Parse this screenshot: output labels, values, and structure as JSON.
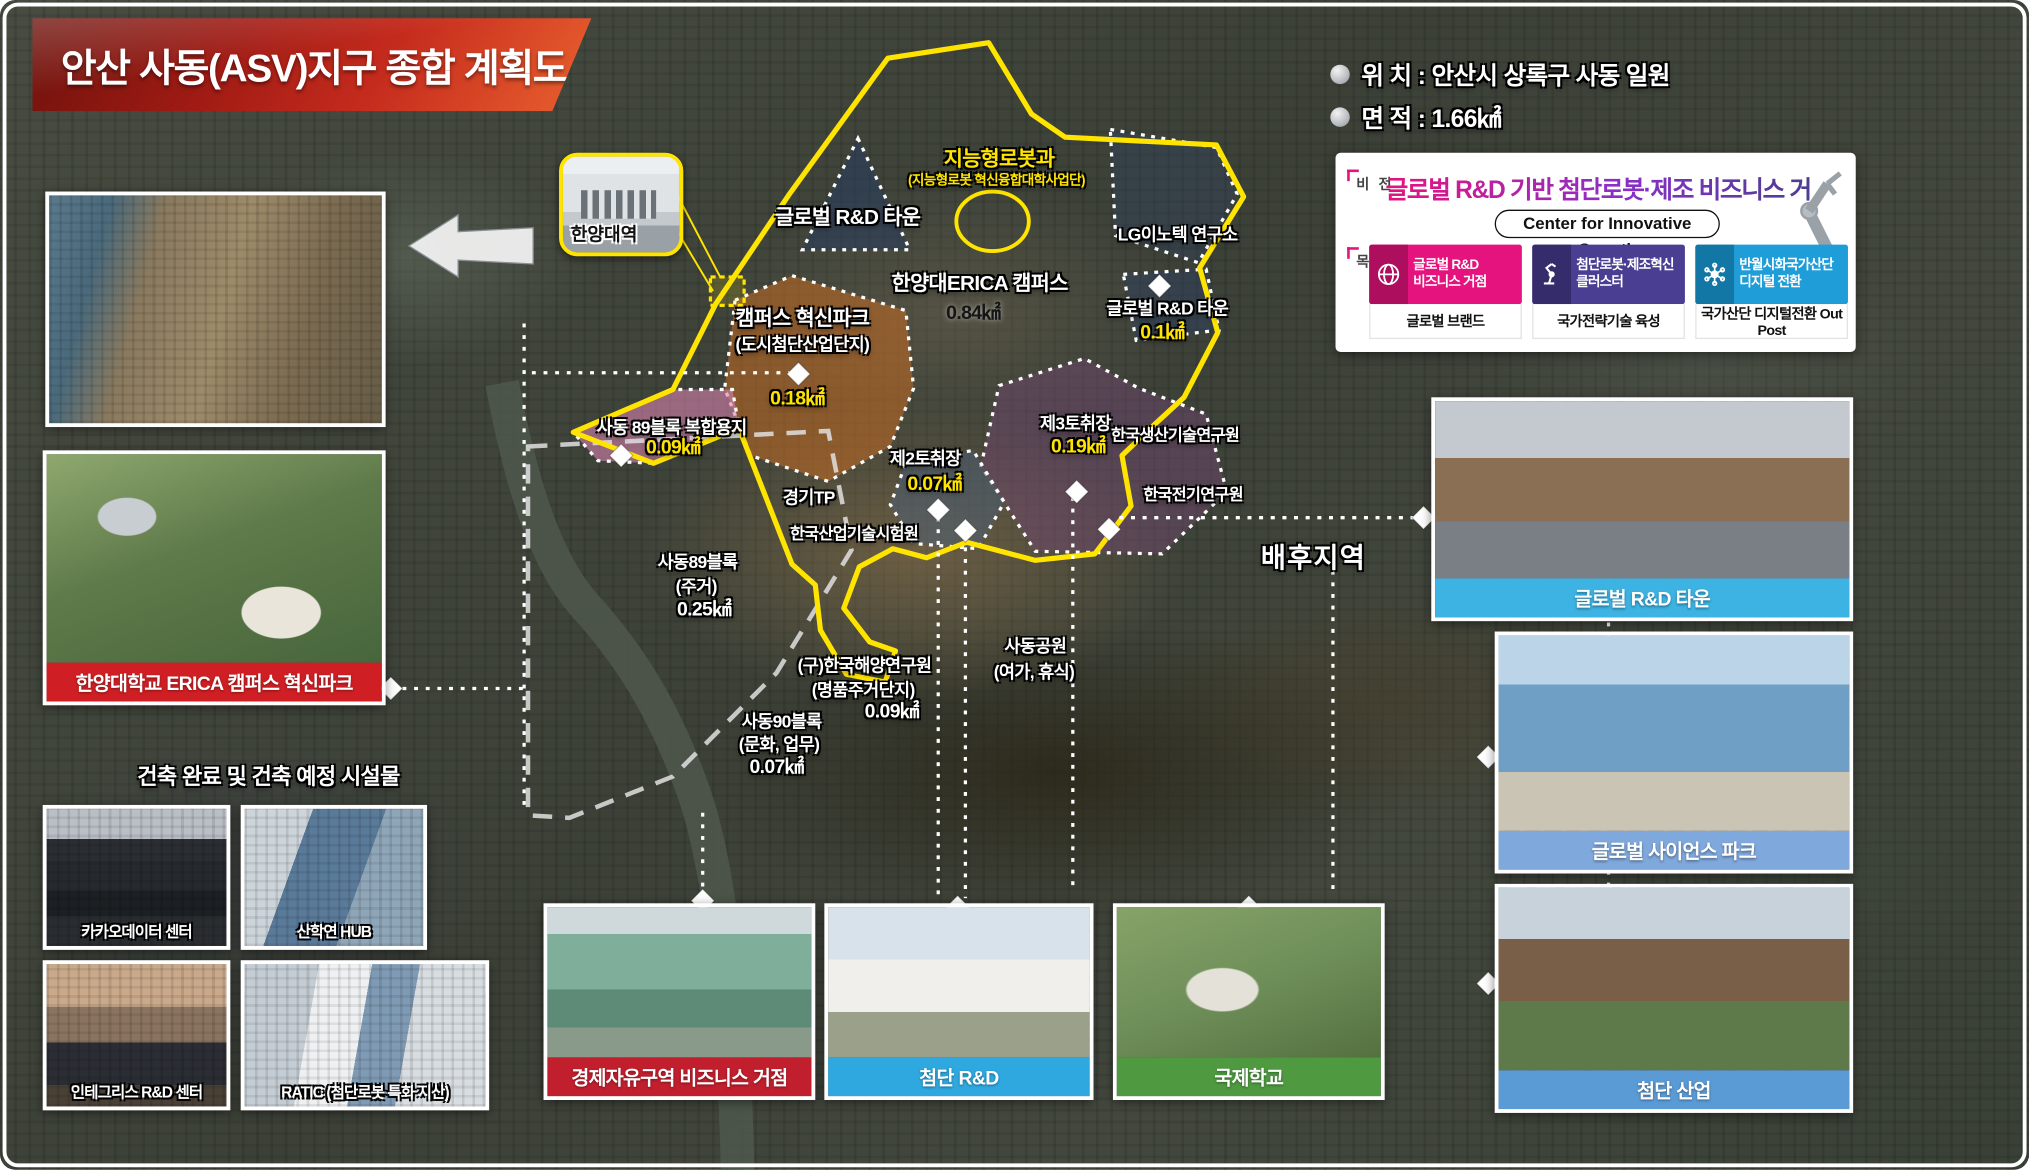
{
  "banner": {
    "title": "안산 사동(ASV)지구 종합 계획도"
  },
  "info": {
    "location_label": "위 치 :",
    "location_value": "안산시 상록구 사동 일원",
    "area_label": "면 적 :",
    "area_value": "1.66㎢"
  },
  "vision_box": {
    "vision_label": "비 전",
    "goal_label": "목 표",
    "title": "글로벌 R&D 기반 첨단로봇·제조 비즈니스 거점",
    "subtitle": "Center for Innovative Growth",
    "goals": [
      {
        "line1": "글로벌 R&D",
        "line2": "비즈니스 거점",
        "sub": "글로벌 브랜드",
        "color": "#e5137d",
        "dark": "#ad0e5e",
        "icon": "globe-icon"
      },
      {
        "line1": "첨단로봇·제조혁신",
        "line2": "클러스터",
        "sub": "국가전략기술 육성",
        "color": "#4a3e92",
        "dark": "#352c6b",
        "icon": "robot-arm-icon"
      },
      {
        "line1": "반월시화국가산단",
        "line2": "디지털 전환",
        "sub": "국가산단 디지털전환 Out Post",
        "color": "#1f9dd9",
        "dark": "#1377a6",
        "icon": "network-icon"
      }
    ]
  },
  "station": {
    "label": "한양대역"
  },
  "map_labels": [
    {
      "text": "지능형로봇과",
      "x": 772,
      "y": 121,
      "cls": "yellow lg"
    },
    {
      "text": "(지능형로봇 혁신융합대학사업단)",
      "x": 770,
      "y": 139,
      "cls": "yellow sm"
    },
    {
      "text": "글로벌 R&D 타운",
      "x": 655,
      "y": 166,
      "cls": "white lg"
    },
    {
      "text": "LG이노텍 연구소",
      "x": 910,
      "y": 180,
      "cls": "white md"
    },
    {
      "text": "한양대ERICA 캠퍼스",
      "x": 757,
      "y": 217,
      "cls": "white lg"
    },
    {
      "text": "0.84㎢",
      "x": 752,
      "y": 241,
      "cls": "black area"
    },
    {
      "text": "글로벌 R&D 타운",
      "x": 902,
      "y": 237,
      "cls": "white md"
    },
    {
      "text": "0.1㎢",
      "x": 898,
      "y": 256,
      "cls": "yellow area"
    },
    {
      "text": "캠퍼스 혁신파크",
      "x": 620,
      "y": 244,
      "cls": "white lg"
    },
    {
      "text": "(도시첨단산업단지)",
      "x": 620,
      "y": 265,
      "cls": "white md"
    },
    {
      "text": "0.18㎢",
      "x": 616,
      "y": 307,
      "cls": "yellow area"
    },
    {
      "text": "사동 89블록 복합용지",
      "x": 519,
      "y": 329,
      "cls": "white md"
    },
    {
      "text": "0.09㎢",
      "x": 520,
      "y": 345,
      "cls": "yellow area"
    },
    {
      "text": "제3토취장",
      "x": 831,
      "y": 326,
      "cls": "white md"
    },
    {
      "text": "0.19㎢",
      "x": 833,
      "y": 344,
      "cls": "yellow area"
    },
    {
      "text": "한국생산기술연구원",
      "x": 908,
      "y": 335,
      "cls": "white sm2"
    },
    {
      "text": "제2토취장",
      "x": 715,
      "y": 353,
      "cls": "white md"
    },
    {
      "text": "0.07㎢",
      "x": 722,
      "y": 373,
      "cls": "yellow area"
    },
    {
      "text": "경기TP",
      "x": 625,
      "y": 383,
      "cls": "white md"
    },
    {
      "text": "한국산업기술시험원",
      "x": 660,
      "y": 411,
      "cls": "white sm2"
    },
    {
      "text": "한국전기연구원",
      "x": 922,
      "y": 381,
      "cls": "white sm2"
    },
    {
      "text": "배후지역",
      "x": 1015,
      "y": 430,
      "cls": "white xl"
    },
    {
      "text": "사동89블록",
      "x": 539,
      "y": 433,
      "cls": "white md"
    },
    {
      "text": "(주거)",
      "x": 538,
      "y": 452,
      "cls": "white md"
    },
    {
      "text": "0.25㎢",
      "x": 544,
      "y": 470,
      "cls": "white area"
    },
    {
      "text": "(구)한국해양연구원",
      "x": 668,
      "y": 513,
      "cls": "white md"
    },
    {
      "text": "(명품주거단지)",
      "x": 667,
      "y": 532,
      "cls": "white md"
    },
    {
      "text": "0.09㎢",
      "x": 689,
      "y": 549,
      "cls": "white area"
    },
    {
      "text": "사동공원",
      "x": 800,
      "y": 498,
      "cls": "white md"
    },
    {
      "text": "(여가, 휴식)",
      "x": 799,
      "y": 518,
      "cls": "white md"
    },
    {
      "text": "사동90블록",
      "x": 604,
      "y": 556,
      "cls": "white md"
    },
    {
      "text": "(문화, 업무)",
      "x": 602,
      "y": 574,
      "cls": "white md"
    },
    {
      "text": "0.07㎢",
      "x": 600,
      "y": 592,
      "cls": "white area"
    }
  ],
  "left_panel": {
    "erica_caption": "한양대학교 ERICA 캠퍼스 혁신파크",
    "erica_caption_color": "#cf1f24",
    "facilities_title": "건축 완료 및 건축 예정 시설물",
    "facilities": [
      {
        "label": "카카오데이터 센터",
        "x": 33,
        "y": 622,
        "w": 145,
        "h": 112,
        "ph": "ph-kakao"
      },
      {
        "label": "산학연 HUB",
        "x": 186,
        "y": 622,
        "w": 144,
        "h": 112,
        "ph": "ph-hub"
      },
      {
        "label": "인테그리스 R&D 센터",
        "x": 33,
        "y": 742,
        "w": 145,
        "h": 116,
        "ph": "ph-integris"
      },
      {
        "label": "RATIC (첨단로봇 특화 지산)",
        "x": 186,
        "y": 742,
        "w": 192,
        "h": 116,
        "ph": "ph-ratic"
      }
    ]
  },
  "bottom_cards": [
    {
      "label": "경제자유구역 비즈니스 거점",
      "color": "#c21f2e",
      "x": 420,
      "y": 698,
      "w": 210,
      "h": 152,
      "ph": "ph-econ"
    },
    {
      "label": "첨단 R&D",
      "color": "#2fa8e0",
      "x": 637,
      "y": 698,
      "w": 208,
      "h": 152,
      "ph": "ph-rnd"
    },
    {
      "label": "국제학교",
      "color": "#4f9a41",
      "x": 860,
      "y": 698,
      "w": 210,
      "h": 152,
      "ph": "ph-school"
    }
  ],
  "right_cards": [
    {
      "label": "글로벌 R&D 타운",
      "color": "#3db3e3",
      "x": 1106,
      "y": 307,
      "w": 326,
      "h": 173,
      "ph": "ph-rndtown"
    },
    {
      "label": "글로벌 사이언스 파크",
      "color": "#7fa8dc",
      "x": 1155,
      "y": 488,
      "w": 277,
      "h": 187,
      "ph": "ph-science"
    },
    {
      "label": "첨단 산업",
      "color": "#5b9bd5",
      "x": 1155,
      "y": 683,
      "w": 277,
      "h": 177,
      "ph": "ph-industry"
    }
  ]
}
